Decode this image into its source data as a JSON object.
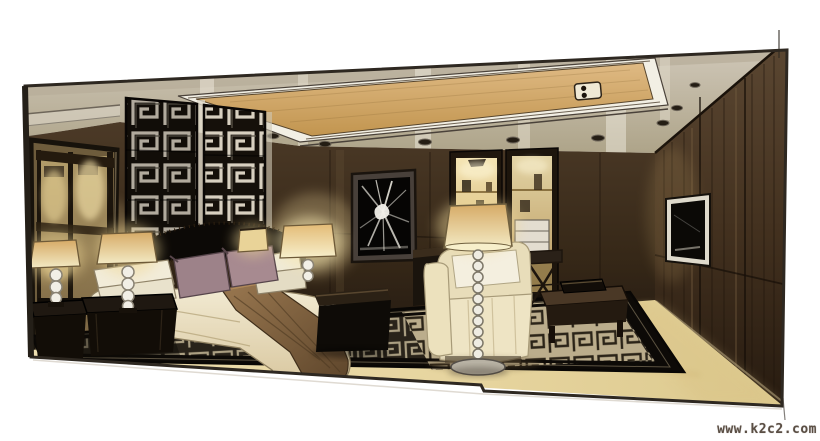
{
  "scene": {
    "medium": "hand-drawn interior design marker rendering",
    "subject": "modern Chinese-style hotel bedroom",
    "description": "Hand-drawn marker rendering of a modern Chinese-style bedroom: dark Greek-key fretwork headboard wall, bed with cream duvet, brown runner and mauve pillows, sphere-stem lamps on dark nightstands, mirrored wardrobe, two lit display niches, cream armchair with bead floor lamp, dark coffee table, Greek-key area rug, dark wood-panelled right wall with wall-mounted TV, and a coved ceiling with tan light cove and recessed downlights",
    "objects": [
      "coved ceiling",
      "tan light cove",
      "recessed downlights",
      "cove light fixture",
      "fretwork headboard wall",
      "mirrored wardrobe",
      "abstract wall artwork",
      "display niche left",
      "display niche right",
      "wall-mounted tv",
      "bed",
      "cream duvet",
      "brown bed runner",
      "mauve pillows",
      "white pillows",
      "dark headboard",
      "foot bench",
      "nightstand left",
      "nightstand right",
      "sphere-stem table lamps",
      "cream armchair",
      "sphere-stem floor lamp",
      "dark coffee table",
      "x-leg luggage rack",
      "greek-key area rug",
      "cream floor"
    ]
  },
  "watermark": {
    "text": "www.k2c2.com",
    "color": "#5a4e44"
  },
  "palette": {
    "paper": "#ffffff",
    "ceiling_taupe": "#c2b9a8",
    "cove_tan": "#d2a96e",
    "back_wall_brown": "#3c2d1d",
    "right_wall_brown": "#4a3826",
    "fretwork_black": "#16110b",
    "duvet_cream": "#ece2c6",
    "runner_brown": "#8a6a44",
    "pillow_mauve": "#9d8289",
    "lamp_glow": "#f0dc9e",
    "rug_dark": "#2b251c",
    "rug_key_light": "#b0a486",
    "floor_cream": "#e8d7a6"
  }
}
